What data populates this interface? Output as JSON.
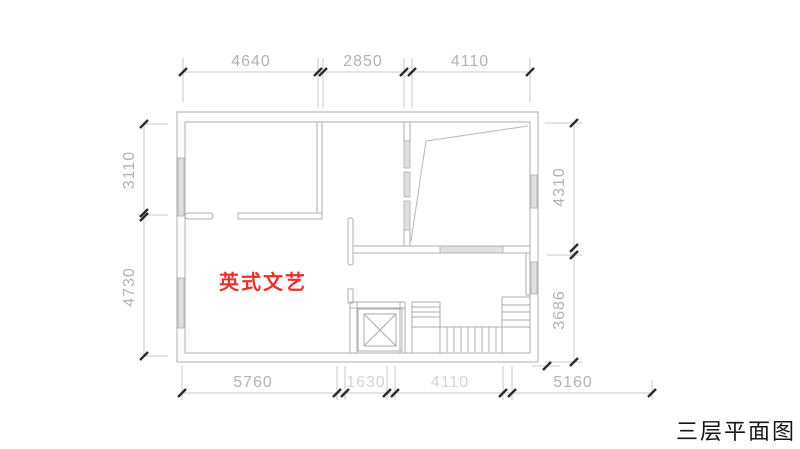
{
  "drawing": {
    "type": "architectural-floor-plan",
    "title": "三层平面图",
    "room_label": "英式文艺",
    "room_label_color": "#e8312a",
    "dimensions": {
      "top": [
        "4640",
        "2850",
        "4110"
      ],
      "left": [
        "3110",
        "4730"
      ],
      "right": [
        "4310",
        "3686"
      ],
      "bottom": [
        "5760",
        "1630",
        "4110",
        "5160"
      ]
    },
    "elements": [
      "exterior-walls",
      "interior-walls",
      "window-openings",
      "sloped-wall-lines",
      "elevator-shaft-with-x",
      "u-shaped-staircase",
      "dimension-lines-with-ticks"
    ],
    "colors": {
      "wall_line": "#adadad",
      "slant_line": "#b8b8b8",
      "dim_line": "#c8c8c8",
      "dim_text": "#b3b3b3",
      "dim_text_faint": "#d4d4d4",
      "tick": "#2b2b2b",
      "window_fill": "#e0e0e0",
      "title_text": "#161616",
      "background": "#ffffff"
    }
  }
}
